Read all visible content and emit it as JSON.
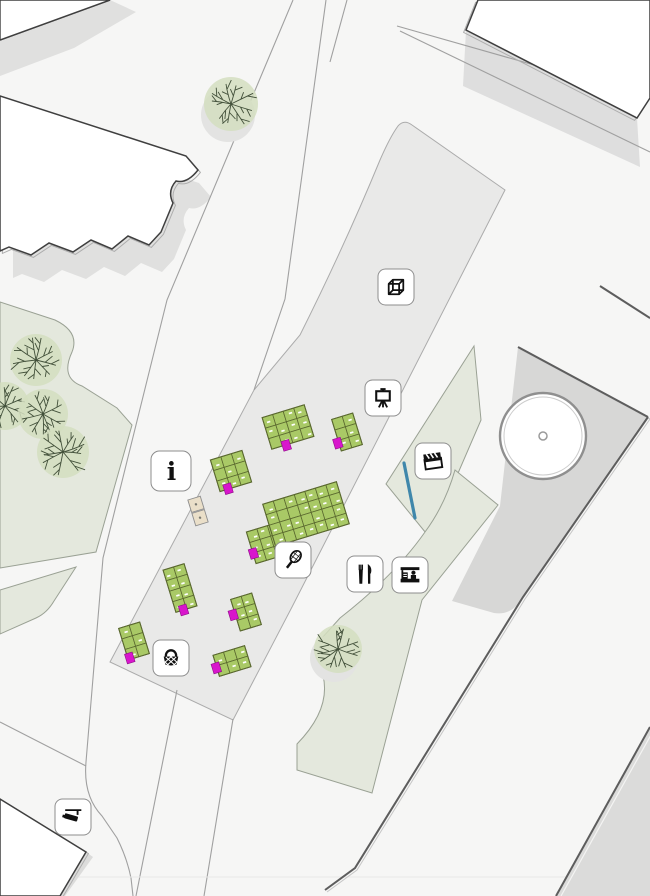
{
  "map": {
    "palette": {
      "background": "#f6f6f5",
      "plaza_gray": "#e9e9e8",
      "courtyard_gray": "#d7d7d6",
      "shadow_gray": "#e0e0df",
      "park_green": "#e4e8dd",
      "tree_fill": "#d3debf",
      "tree_stroke": "#42503a",
      "stall_green": "#a9c966",
      "stall_outline": "#5a682f",
      "accent_magenta": "#d816cc",
      "kiosk_tan": "#eadfc9",
      "building_fill": "#ffffff",
      "building_outline": "#3f3f3f",
      "road_line": "#a0a0a0",
      "water_blue": "#3f87ab",
      "icon_black": "#111111"
    },
    "markers": [
      {
        "id": "pavilion",
        "icon": "cube-icon",
        "x": 396,
        "y": 287
      },
      {
        "id": "exhibition",
        "icon": "easel-icon",
        "x": 383,
        "y": 398
      },
      {
        "id": "information",
        "icon": "info-icon",
        "x": 171,
        "y": 471,
        "label": "i"
      },
      {
        "id": "cinema",
        "icon": "clapperboard-icon",
        "x": 433,
        "y": 461
      },
      {
        "id": "sports",
        "icon": "tennis-racket-icon",
        "x": 293,
        "y": 560
      },
      {
        "id": "food",
        "icon": "cutlery-icon",
        "x": 365,
        "y": 574
      },
      {
        "id": "market-stand",
        "icon": "market-stall-icon",
        "x": 410,
        "y": 575
      },
      {
        "id": "picnic",
        "icon": "picnic-basket-icon",
        "x": 171,
        "y": 658
      },
      {
        "id": "surveillance",
        "icon": "cctv-camera-icon",
        "x": 73,
        "y": 817
      }
    ]
  }
}
